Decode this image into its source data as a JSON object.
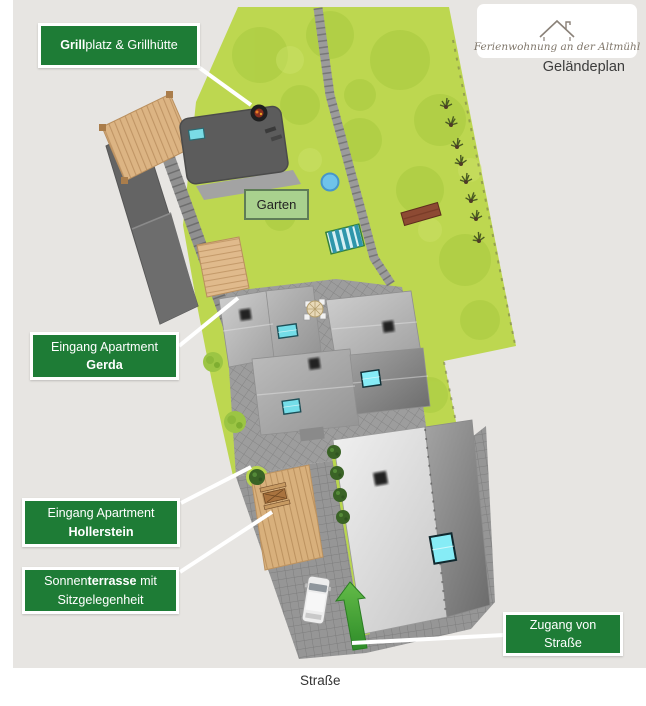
{
  "header": {
    "logo_text": "Ferienwohnung an der Altmühl",
    "plan_title": "Geländeplan"
  },
  "callouts": {
    "grillplatz": {
      "bold": "Grill",
      "rest": "platz & Grillhütte"
    },
    "gerda": {
      "line1": "Eingang Apartment",
      "line2": "Gerda"
    },
    "hollerstein": {
      "line1": "Eingang Apartment",
      "line2": "Hollerstein"
    },
    "sonnenterrasse": {
      "pre": "Sonnen",
      "bold": "terrasse",
      "post": " mit",
      "line2": "Sitzgelegenheit"
    },
    "zugang": {
      "line1": "Zugang von",
      "line2": "Straße"
    }
  },
  "map": {
    "garden_label": "Garten",
    "street_label": "Straße"
  },
  "colors": {
    "callout_green": "#1e7c36",
    "garden_green": "#bdd750",
    "garden_label_bg": "#a9d18e",
    "arrow_green": "#3fa33a",
    "plan_background": "#e7e5e2",
    "skylight_cyan": "#7adce6"
  }
}
